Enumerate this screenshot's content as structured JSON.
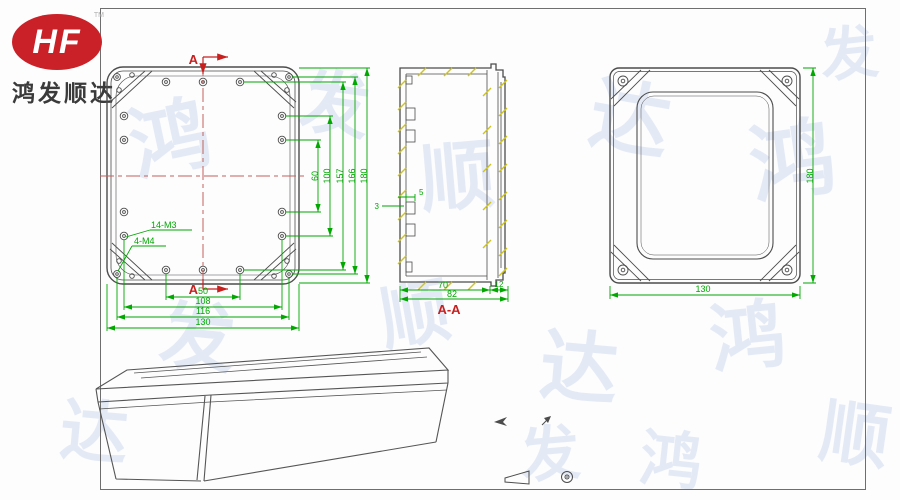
{
  "logo": {
    "brand": "HF",
    "trademark": "TM",
    "company": "鸿发顺达"
  },
  "watermark": {
    "chars": [
      "鸿",
      "发",
      "顺",
      "达"
    ]
  },
  "front_view": {
    "section_label_top": "A",
    "section_label_bottom": "A",
    "thread_label_m3": "14-M3",
    "thread_label_m4": "4-M4",
    "dims_vertical": [
      "60",
      "100",
      "157",
      "166",
      "180"
    ],
    "dims_horizontal": [
      "50",
      "108",
      "116",
      "130"
    ]
  },
  "section_view": {
    "title": "A-A",
    "dim_depth": "70",
    "dim_lid": "12",
    "dim_total": "82",
    "dim_boss_width": "5",
    "dim_boss_offset": "3"
  },
  "back_view": {
    "dim_height": "180",
    "dim_width": "130"
  },
  "colors": {
    "dimension_green": "#00a800",
    "section_red": "#c8201e",
    "centerline_red": "#c4605c",
    "hatch_yellow": "#cfc41f",
    "drawing_gray": "#4c4c4c",
    "logo_red": "#ca2128",
    "watermark_blue": "#dce4f3"
  }
}
